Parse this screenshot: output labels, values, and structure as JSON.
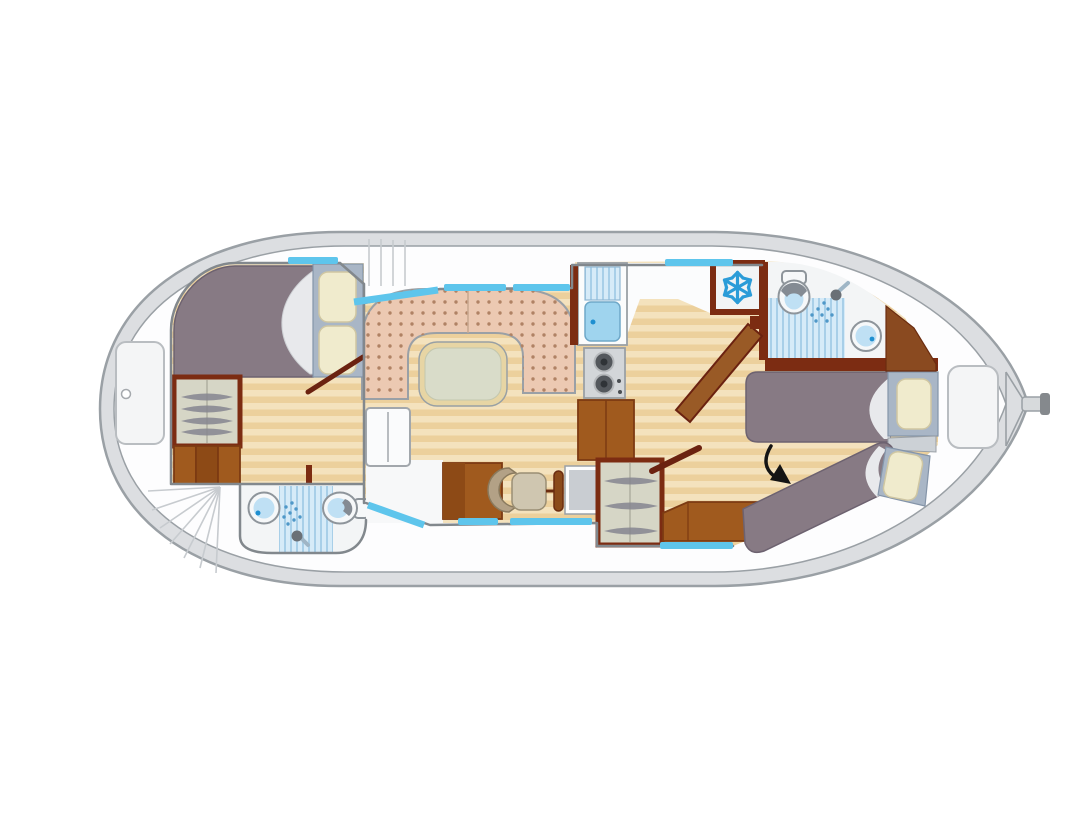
{
  "image": {
    "kind": "boat-floor-plan",
    "description": "Top-down deck plan of a canal houseboat with bow double-bed cabin, forward shower room, U-shaped dinette salon, inside helm station, galley with fridge, aft shower room and aft twin-berth cabin; a black arrow annotation points to the lower aft berth.",
    "visible_text": []
  },
  "icons": {
    "snowflake-icon": "fridge-freezer",
    "shower-spray-icon": "shower head with spray",
    "hanger-icon": "clothes on wardrobe rail",
    "arrow-icon": "curved black annotation arrow",
    "burner-icon": "two-ring stove"
  },
  "rooms": [
    {
      "id": "bow-cabin",
      "features": [
        "double-bed",
        "wardrobe",
        "steps",
        "door"
      ]
    },
    {
      "id": "forward-bathroom",
      "features": [
        "washbasin",
        "shower",
        "toilet"
      ]
    },
    {
      "id": "salon",
      "features": [
        "u-shaped-dinette",
        "table",
        "bench-locker",
        "helm-cabinet",
        "helm-chair",
        "steering-wheel",
        "helm-console"
      ]
    },
    {
      "id": "galley",
      "features": [
        "sink-drainer",
        "two-burner-stove",
        "lower-cabinet",
        "fridge"
      ]
    },
    {
      "id": "aft-bathroom",
      "features": [
        "toilet",
        "shower",
        "washbasin"
      ]
    },
    {
      "id": "aft-cabin",
      "features": [
        "single-bed-upper",
        "single-bed-lower",
        "nightstand",
        "wardrobe",
        "sideboard",
        "door"
      ]
    },
    {
      "id": "decks",
      "features": [
        "bow-locker",
        "stern-locker",
        "fan-steps",
        "side-walkways",
        "tiller"
      ]
    }
  ],
  "colors": {
    "page_bg": "#ffffff",
    "hull_band": "#dcdee1",
    "hull_stroke": "#9aa0a5",
    "deck_white": "#fdfdfe",
    "deck_line": "#c7cbcf",
    "wall_gray": "#82888d",
    "wall_maroon": "#7c2c12",
    "door_brown": "#6b2210",
    "wood_light": "#f4e2bd",
    "wood_dark": "#ecd09c",
    "window_blue": "#5ec5ec",
    "water_blue": "#bfe0f4",
    "water_dot": "#1f8fd0",
    "shower_bg": "#d6ebf8",
    "shower_stripe": "#a8cfe8",
    "fixture_white": "#f6f8f9",
    "fixture_stroke": "#8e959b",
    "bed_blanket": "#877a84",
    "bed_blanket_stroke": "#6d6270",
    "bed_turndown": "#e8e9ec",
    "bed_base": "#a9b6c6",
    "bed_base_stroke": "#8494a8",
    "pillow": "#f0ebcd",
    "pillow_stroke": "#cfc6a2",
    "dinette": "#ecc9b2",
    "dinette_dot": "#b08264",
    "sofa_stroke": "#9aa0a6",
    "table_top": "#d9dcc9",
    "table_edge": "#e7d5a4",
    "cabinet_brown": "#a05a1e",
    "cabinet_brown_dark": "#8d4a16",
    "cabinet_stroke": "#7c3a12",
    "wardrobe_bg": "#d6d6c6",
    "hanger": "#85858f",
    "chair_back": "#b3a186",
    "chair_seat": "#cfc6b0",
    "console_screen": "#c9cdd2",
    "stove_body": "#d3d6d9",
    "burner": "#54585d",
    "snowflake": "#2b9cd8",
    "arrow": "#141414"
  }
}
